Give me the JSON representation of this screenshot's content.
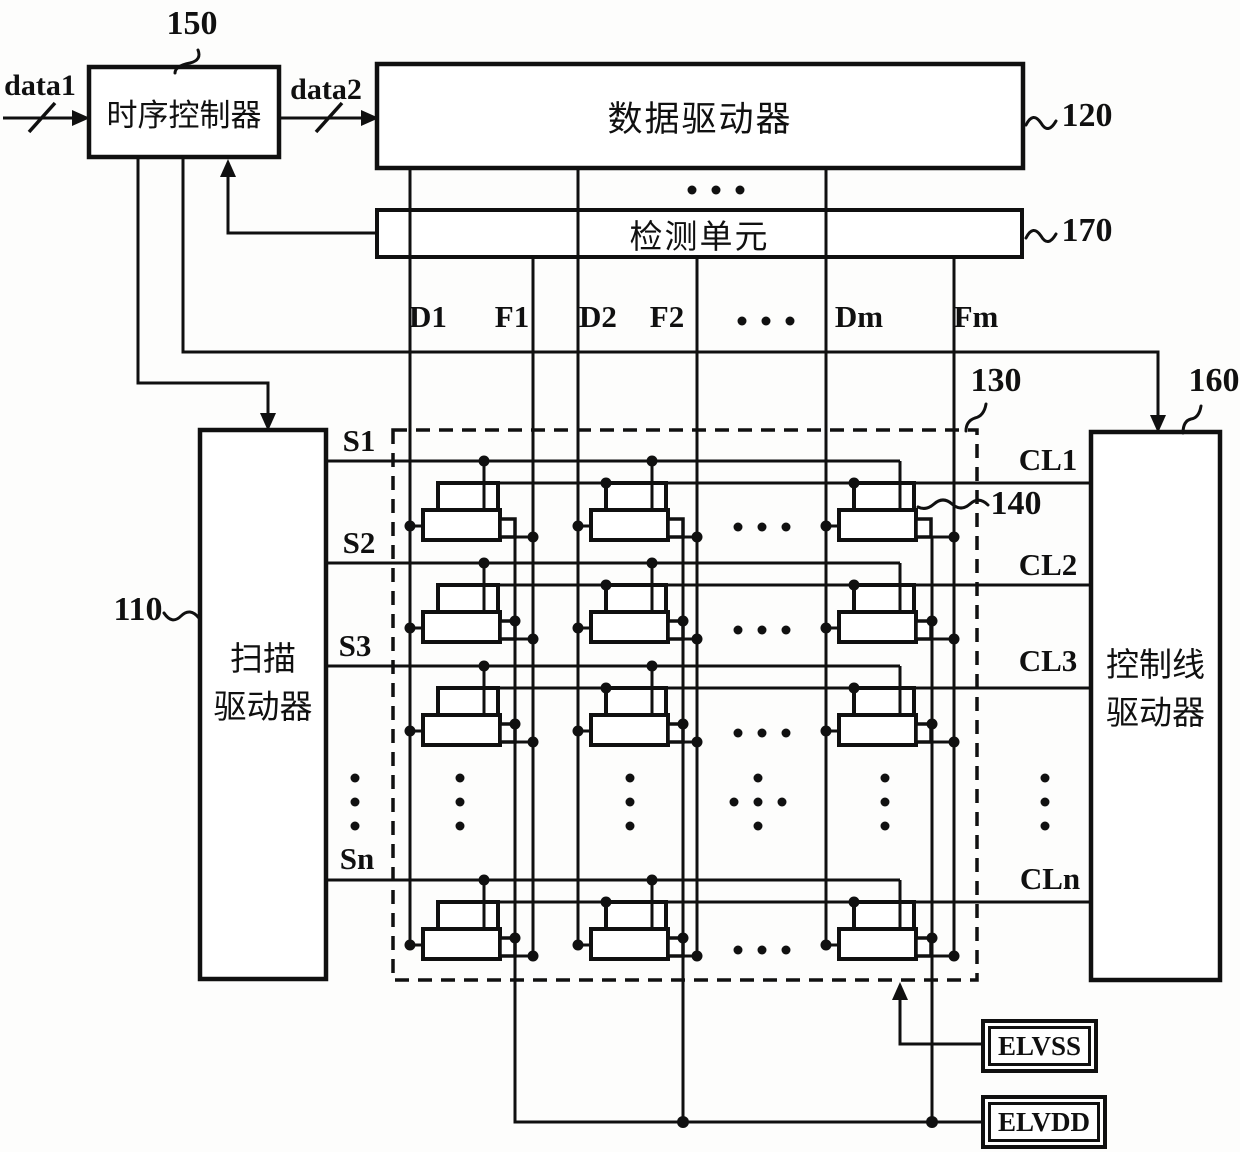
{
  "figure": {
    "blocks": {
      "timing_controller": {
        "label": "时序控制器",
        "ref": "150"
      },
      "data_driver": {
        "label": "数据驱动器",
        "ref": "120"
      },
      "detection_unit": {
        "label": "检测单元",
        "ref": "170"
      },
      "scan_driver": {
        "label_line1": "扫描",
        "label_line2": "驱动器",
        "ref": "110"
      },
      "control_line_driver": {
        "label_line1": "控制线",
        "label_line2": "驱动器",
        "ref": "160"
      },
      "pixel_array": {
        "ref": "130"
      },
      "pixel": {
        "ref": "140"
      },
      "elvss": {
        "label": "ELVSS"
      },
      "elvdd": {
        "label": "ELVDD"
      }
    },
    "signals": {
      "inputs": {
        "data1": "data1",
        "data2": "data2"
      },
      "column_labels": [
        "D1",
        "F1",
        "D2",
        "F2",
        "Dm",
        "Fm"
      ],
      "scan_labels": [
        "S1",
        "S2",
        "S3",
        "Sn"
      ],
      "control_labels": [
        "CL1",
        "CL2",
        "CL3",
        "CLn"
      ]
    },
    "colors": {
      "ink": "#101010",
      "paper": "#fdfdfc"
    }
  }
}
